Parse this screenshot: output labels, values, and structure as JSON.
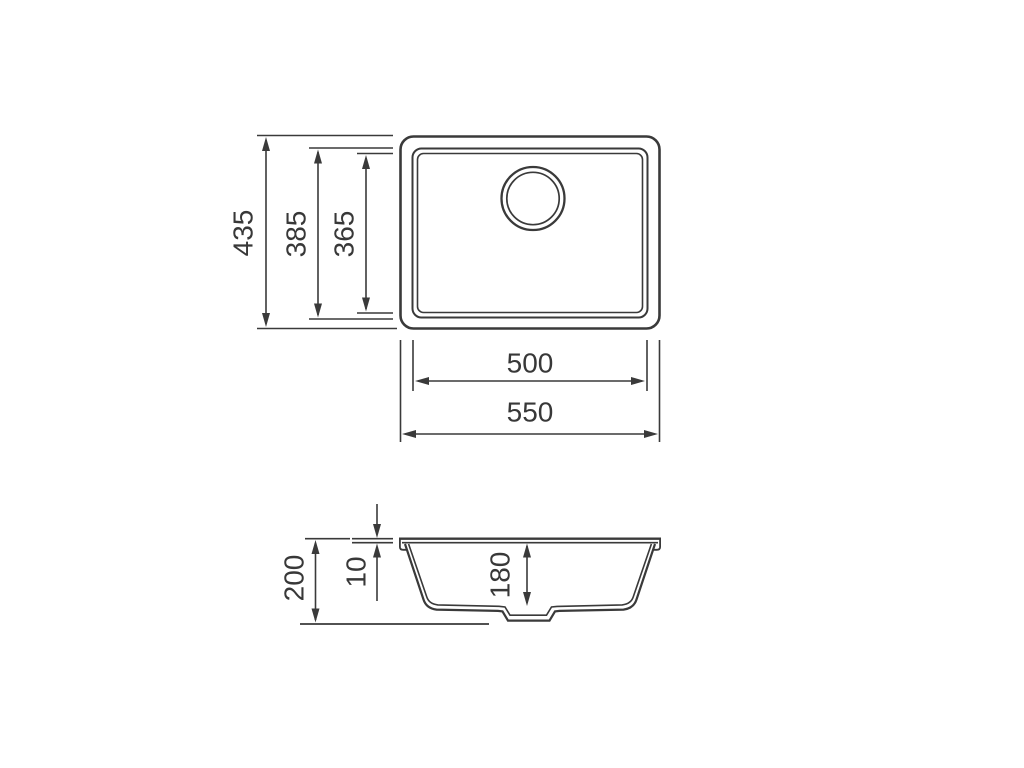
{
  "drawing": {
    "kind": "sink-technical-drawing",
    "colors": {
      "line": "#3a3a3a",
      "background": "#ffffff"
    },
    "top_view": {
      "name": "top view",
      "dims": {
        "overall_height": "435",
        "bowl_height": "385",
        "inner_height": "365",
        "bowl_width": "500",
        "overall_width": "550"
      }
    },
    "section_view": {
      "name": "section view",
      "dims": {
        "overall_depth": "200",
        "rim_thickness": "10",
        "bowl_depth": "180"
      }
    }
  }
}
